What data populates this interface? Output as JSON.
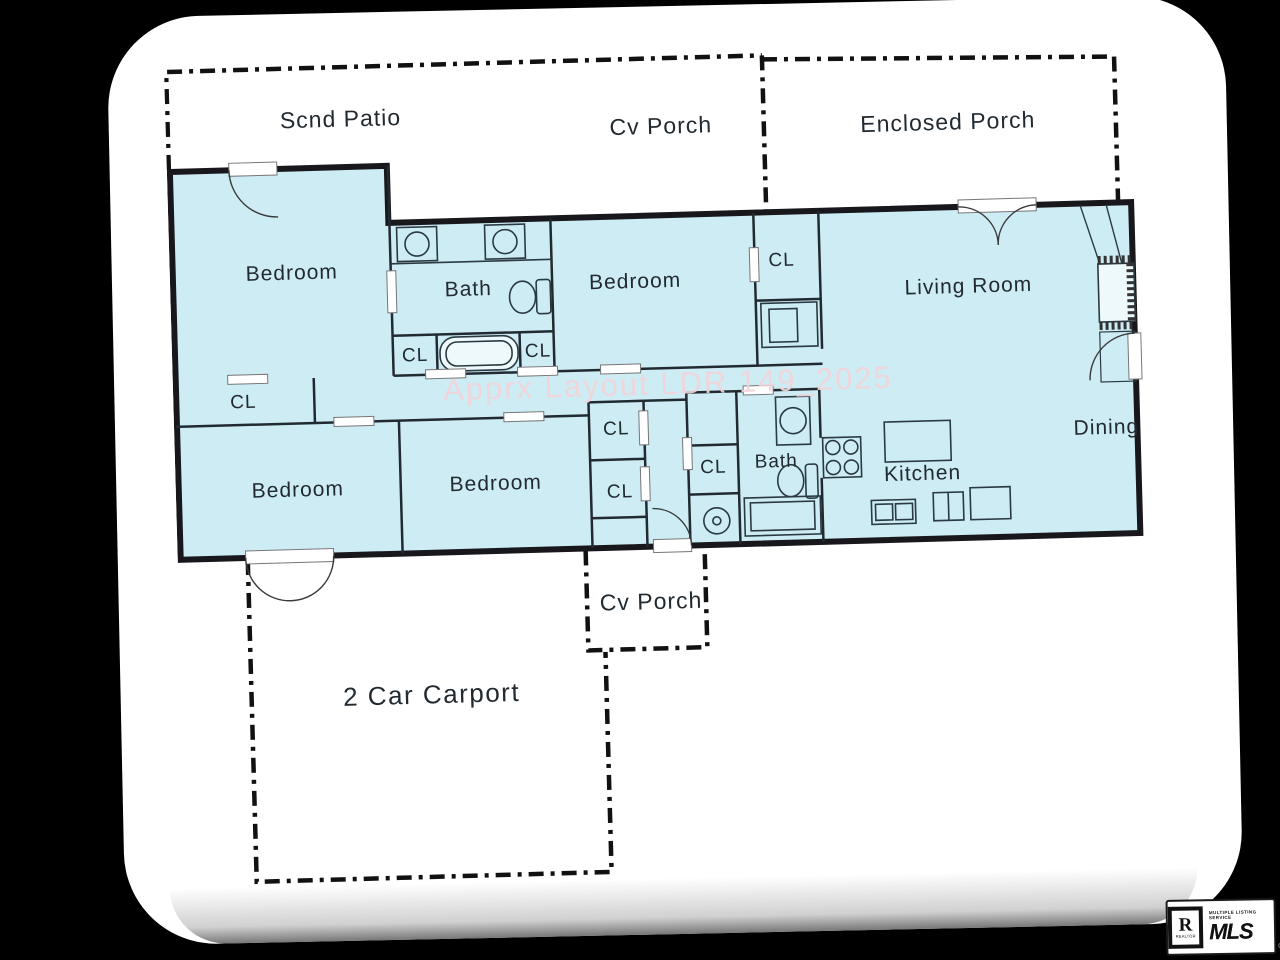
{
  "watermark": "Apprx Layout LDR 149_2025",
  "labels": {
    "scnd_patio": "Scnd Patio",
    "cv_porch_top": "Cv Porch",
    "enclosed_porch": "Enclosed Porch",
    "bedroom_top_left": "Bedroom",
    "bath_top": "Bath",
    "bedroom_top_middle": "Bedroom",
    "cl_bedroom2": "CL",
    "living_room": "Living Room",
    "cl_bath_left": "CL",
    "cl_bath_right": "CL",
    "cl_hall": "CL",
    "bedroom_bottom_left": "Bedroom",
    "bedroom_bottom_middle": "Bedroom",
    "cl_stack_upper": "CL",
    "cl_stack_lower": "CL",
    "cl_bottom": "CL",
    "bath_bottom": "Bath",
    "kitchen": "Kitchen",
    "dining": "Dining",
    "cv_porch_bottom": "Cv Porch",
    "carport": "2 Car Carport"
  },
  "logo": {
    "r": "R",
    "realtor": "REALTOR",
    "tagline": "MULTIPLE LISTING SERVICE",
    "mls": "MLS",
    "reg": "®"
  },
  "colors": {
    "background": "#000000",
    "page": "#ffffff",
    "floor_fill": "#cdecf4",
    "wall": "#17171c",
    "watermark": "#f2d4d9"
  }
}
